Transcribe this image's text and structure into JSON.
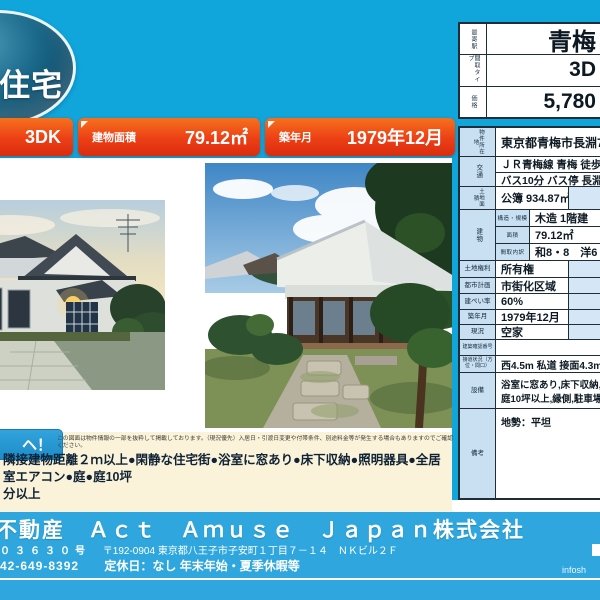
{
  "colors": {
    "page_background": "#10a6dc",
    "footer_background": "#2fa7de",
    "badge_red": "#ed3f16",
    "label_cell_blue": "#c9e0f2",
    "cream_strip": "#faf3da",
    "oval_badge_navy": "#0d4a66"
  },
  "oval_badge": {
    "text": "中古住宅"
  },
  "top_badges": [
    {
      "value": "3DK"
    },
    {
      "label": "建物面積",
      "value": "79.12㎡"
    },
    {
      "label": "築年月",
      "value": "1979年12月"
    }
  ],
  "price_table": {
    "rows": [
      {
        "label": "最寄駅",
        "value": "青梅"
      },
      {
        "label": "間取タイプ",
        "value": "3D"
      },
      {
        "label": "価格",
        "value": "5,780"
      }
    ]
  },
  "spec_table": {
    "location": {
      "label": "物件所在地",
      "value": "東京都青梅市長淵7丁目"
    },
    "access": {
      "label": "交通",
      "line1": "ＪＲ青梅線 青梅 徒歩22分",
      "line2": "バス10分 バス停 長淵7丁"
    },
    "land_area": {
      "label": "土地面積",
      "value": "公簿 934.87㎡"
    },
    "building": {
      "label": "建物",
      "rows": [
        {
          "label": "構造・規模",
          "value": "木造 1階建"
        },
        {
          "label": "面積",
          "value": "79.12㎡"
        },
        {
          "label": "間取内訳",
          "value": "和8・8　洋6"
        }
      ]
    },
    "rows": [
      {
        "label": "土地権利",
        "value": "所有権"
      },
      {
        "label": "都市計画",
        "value": "市街化区域"
      },
      {
        "label": "建ぺい率",
        "value": "60%"
      },
      {
        "label": "築年月",
        "value": "1979年12月"
      },
      {
        "label": "現況",
        "value": "空家"
      },
      {
        "label": "建築確認番号",
        "value": ""
      },
      {
        "label": "接道状況（方位・間口）",
        "value": "西4.5m 私道 接面4.3m 位"
      }
    ],
    "equipment": {
      "label": "設備",
      "line1": "浴室に窓あり,床下収納,照明",
      "line2": "庭10坪以上,縁側,駐車場"
    },
    "remarks": {
      "label": "備考",
      "value": "地勢：平坦"
    }
  },
  "highlight": {
    "badge_text": "ヘ！",
    "disclaimer": "この図面は物件情報の一部を抜粋して掲載しております。（現況優先）入居日・引渡日変更や付帯条件、別途料金等が発生する場合もありますのでご確認ください。",
    "features_line1": "隣接建物距離２ｍ以上●閑静な住宅街●浴室に窓あり●床下収納●照明器具●全居室エアコン●庭●庭10坪",
    "features_line2": "分以上"
  },
  "footer": {
    "company": "不動産　Ａｃｔ　Ａｍｕｓｅ　Ｊａｐａｎ株式会社",
    "license": "０３６３０号",
    "address": "〒192-0904 東京都八王子市子安町１丁目７－１４　ＮＫビル２Ｆ",
    "phone": "42-649-8392",
    "holidays": "定休日：なし 年末年始・夏季休暇等",
    "watermark": "infosh"
  }
}
